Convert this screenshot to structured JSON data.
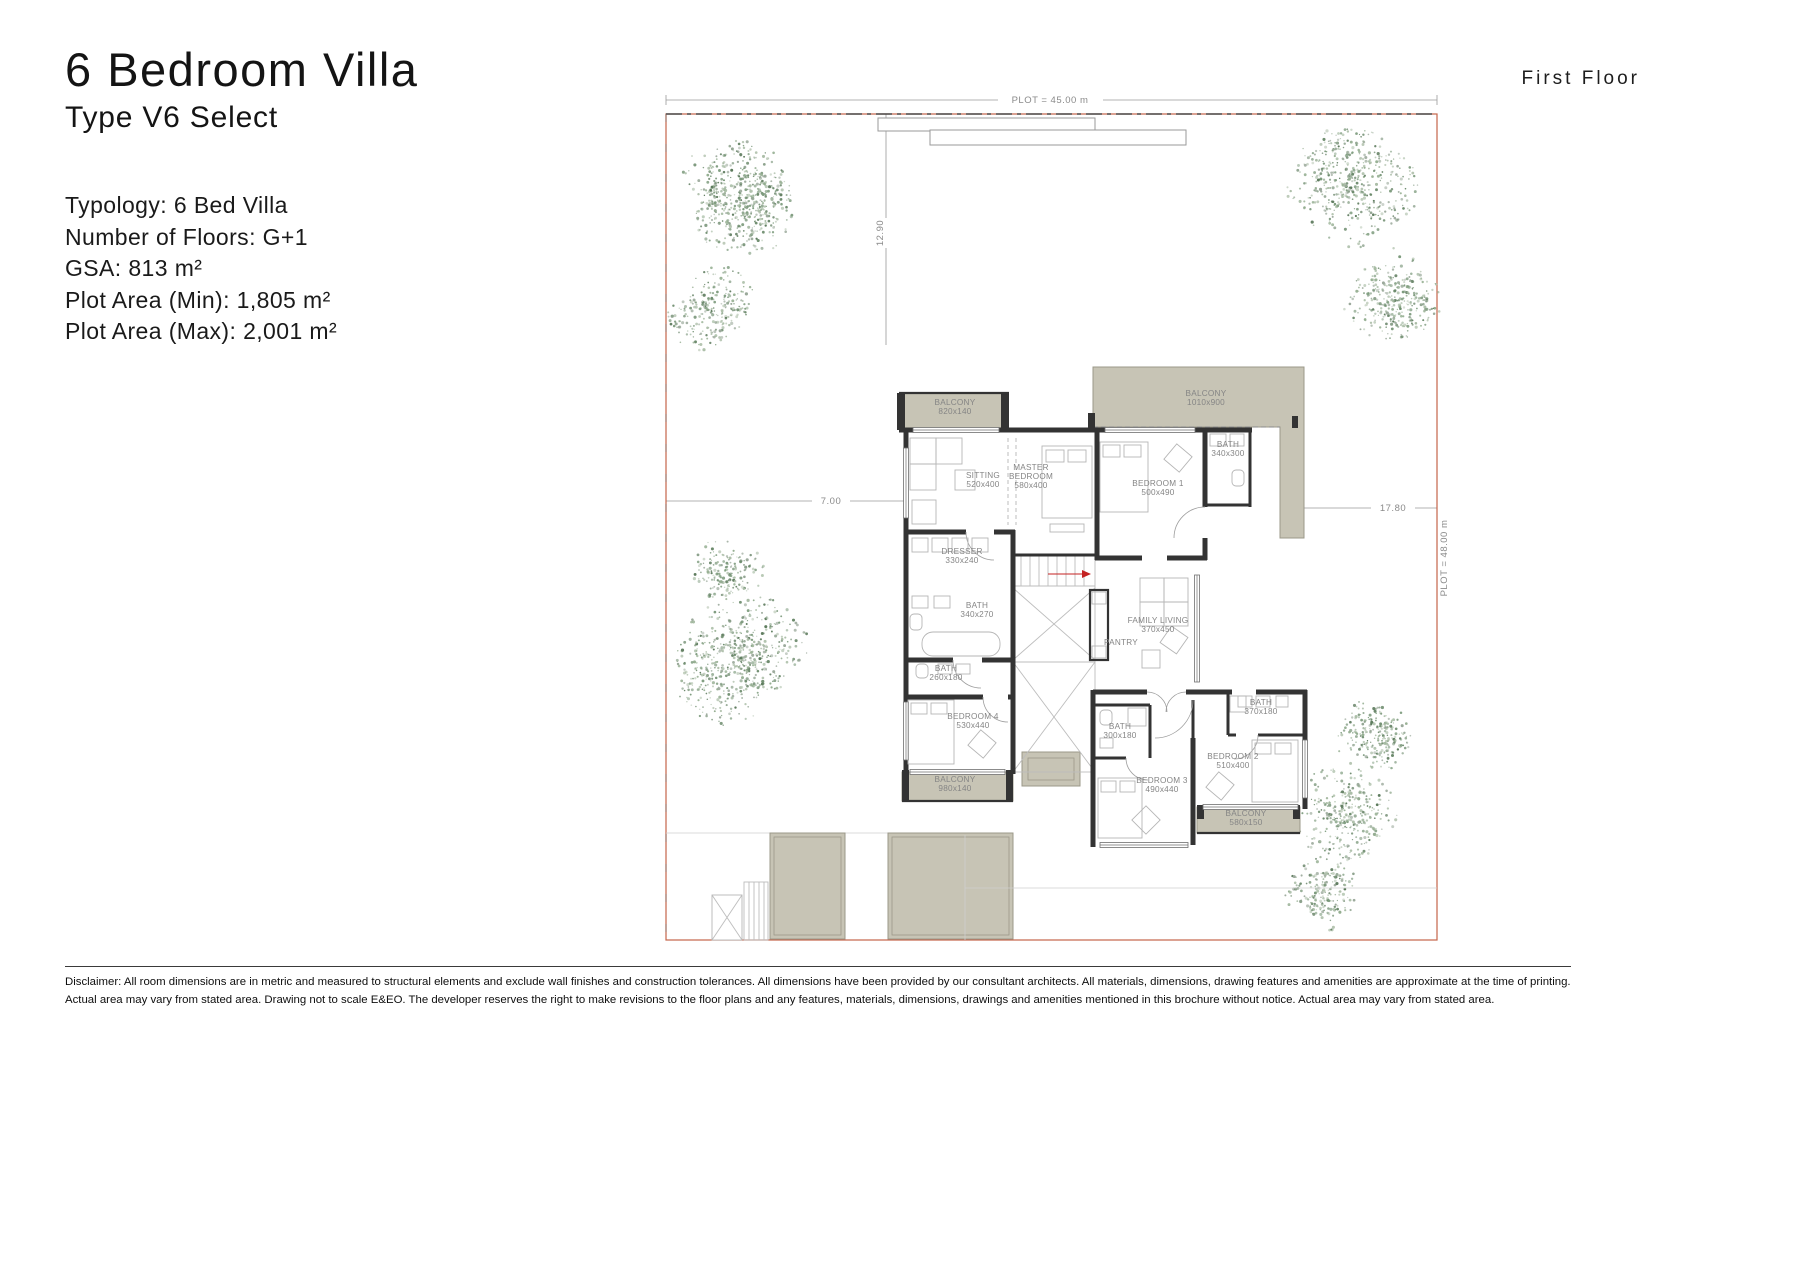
{
  "header": {
    "title": "6 Bedroom Villa",
    "subtitle": "Type V6 Select"
  },
  "floor_label": "First Floor",
  "specs": {
    "lines": [
      "Typology: 6 Bed Villa",
      "Number of Floors: G+1",
      "GSA: 813 m²",
      "Plot Area (Min): 1,805 m²",
      "Plot Area (Max): 2,001 m²"
    ]
  },
  "disclaimer": {
    "line1": "Disclaimer: All room dimensions are in metric and measured to structural elements and exclude wall finishes and construction tolerances. All dimensions have been provided by our consultant architects. All materials, dimensions, drawing features and amenities are approximate at the time of printing.",
    "line2": "Actual area may vary from stated area. Drawing not to scale E&EO. The developer reserves the right to make revisions to the floor plans and any features, materials, dimensions, drawings and amenities mentioned in this brochure without notice. Actual area may vary from stated area."
  },
  "colors": {
    "balcony_fill": "#c7c4b5",
    "balcony_edge": "#9b9889",
    "wall": "#333333",
    "boundary": "#c4654a",
    "dim_text": "#8a8a8a",
    "room_text": "#858585",
    "furniture": "#b5b5b5",
    "stair_arrow": "#c42222",
    "tree_palette": [
      "#7d9b7d",
      "#93ad8f",
      "#a8bba4",
      "#6b8a6b",
      "#b4c4b0",
      "#5c7a5c",
      "#9aa89a"
    ]
  },
  "plan": {
    "dimensions": [
      {
        "id": "plot-width",
        "label": "PLOT = 45.00 m",
        "x": 1050,
        "y": 103,
        "rotate": 0
      },
      {
        "id": "dim-12-90",
        "label": "12.90",
        "x": 883,
        "y": 233,
        "rotate": -90
      },
      {
        "id": "dim-7-00",
        "label": "7.00",
        "x": 831,
        "y": 504,
        "rotate": 0
      },
      {
        "id": "dim-17-80",
        "label": "17.80",
        "x": 1393,
        "y": 511,
        "rotate": 0
      },
      {
        "id": "plot-depth",
        "label": "PLOT = 48.00 m",
        "x": 1447,
        "y": 558,
        "rotate": -90
      }
    ],
    "rooms": [
      {
        "id": "balcony-1",
        "lines": [
          "BALCONY",
          "820x140"
        ],
        "x": 955,
        "y": 405
      },
      {
        "id": "balcony-master",
        "lines": [
          "BALCONY",
          "1010x900"
        ],
        "x": 1206,
        "y": 396
      },
      {
        "id": "sitting",
        "lines": [
          "SITTING",
          "520x400"
        ],
        "x": 983,
        "y": 478
      },
      {
        "id": "master-bedroom",
        "lines": [
          "MASTER",
          "BEDROOM",
          "580x400"
        ],
        "x": 1031,
        "y": 470
      },
      {
        "id": "bedroom-1",
        "lines": [
          "BEDROOM 1",
          "500x490"
        ],
        "x": 1158,
        "y": 486
      },
      {
        "id": "bath-bedroom-1",
        "lines": [
          "BATH",
          "340x300"
        ],
        "x": 1228,
        "y": 447
      },
      {
        "id": "dresser",
        "lines": [
          "DRESSER",
          "330x240"
        ],
        "x": 962,
        "y": 554
      },
      {
        "id": "bath-master",
        "lines": [
          "BATH",
          "340x270"
        ],
        "x": 977,
        "y": 608
      },
      {
        "id": "family-living",
        "lines": [
          "FAMILY LIVING",
          "370x450"
        ],
        "x": 1158,
        "y": 623
      },
      {
        "id": "pantry",
        "lines": [
          "PANTRY"
        ],
        "x": 1121,
        "y": 645
      },
      {
        "id": "bath-shared",
        "lines": [
          "BATH",
          "260x180"
        ],
        "x": 946,
        "y": 671
      },
      {
        "id": "bedroom-4",
        "lines": [
          "BEDROOM 4",
          "530x440"
        ],
        "x": 973,
        "y": 719
      },
      {
        "id": "balcony-bed-4",
        "lines": [
          "BALCONY",
          "980x140"
        ],
        "x": 955,
        "y": 782
      },
      {
        "id": "bath-bed-3",
        "lines": [
          "BATH",
          "300x180"
        ],
        "x": 1120,
        "y": 729
      },
      {
        "id": "bedroom-3",
        "lines": [
          "BEDROOM 3",
          "490x440"
        ],
        "x": 1162,
        "y": 783
      },
      {
        "id": "bath-bed-2",
        "lines": [
          "BATH",
          "370x180"
        ],
        "x": 1261,
        "y": 705
      },
      {
        "id": "bedroom-2",
        "lines": [
          "BEDROOM 2",
          "510x400"
        ],
        "x": 1233,
        "y": 759
      },
      {
        "id": "balcony-bed-2",
        "lines": [
          "BALCONY",
          "580x150"
        ],
        "x": 1246,
        "y": 816
      }
    ],
    "trees": [
      {
        "cx": 737,
        "cy": 212,
        "r": 72
      },
      {
        "cx": 713,
        "cy": 308,
        "r": 48
      },
      {
        "cx": 728,
        "cy": 572,
        "r": 40
      },
      {
        "cx": 748,
        "cy": 668,
        "r": 74
      },
      {
        "cx": 1352,
        "cy": 186,
        "r": 66
      },
      {
        "cx": 1394,
        "cy": 288,
        "r": 54
      },
      {
        "cx": 1371,
        "cy": 727,
        "r": 47
      },
      {
        "cx": 1348,
        "cy": 813,
        "r": 54
      },
      {
        "cx": 1327,
        "cy": 892,
        "r": 42
      }
    ]
  }
}
